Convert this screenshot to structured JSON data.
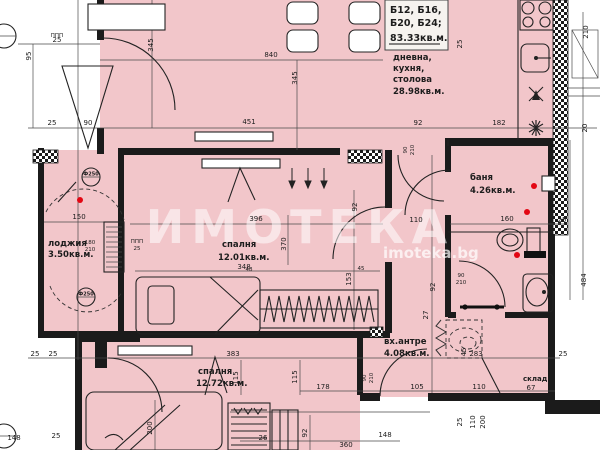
{
  "colors": {
    "room_fill": "#f2c6ca",
    "wall": "#1b1b1b",
    "red_dot": "#e30613",
    "hatch": "#1b1b1b"
  },
  "title_block": {
    "line1": "Б12, Б16,",
    "line2": "Б20, Б24;",
    "area": "83.33кв.м."
  },
  "watermark": {
    "brand": "ИМОТЕКА",
    "site": "imoteka.bg"
  },
  "rooms": {
    "living": {
      "l1": "дневна,",
      "l2": "кухня,",
      "l3": "столова",
      "area": "28.98кв.м."
    },
    "bedroom1": {
      "name": "спалня",
      "area": "12.01кв.м."
    },
    "bedroom2": {
      "name": "спалня",
      "area": "12.72кв.м."
    },
    "loggia": {
      "name": "лоджия",
      "area": "3.50кв.м."
    },
    "bath": {
      "name": "баня",
      "area": "4.26кв.м."
    },
    "entry": {
      "name": "вх.антре",
      "area": "4.08кв.м."
    },
    "storage": {
      "name": "склад"
    }
  },
  "markers": {
    "column1": "Ф250",
    "column2": "Ф250",
    "ppp1": "ППП",
    "ppp2": "ППП"
  },
  "dims": [
    "25",
    "345",
    "840",
    "345",
    "95",
    "210",
    "20",
    "25",
    "90",
    "451",
    "92",
    "182",
    "25",
    "150",
    "180",
    "210",
    "25",
    "396",
    "370",
    "348",
    "92",
    "153",
    "48",
    "45",
    "90",
    "210",
    "110",
    "160",
    "25",
    "90",
    "210",
    "27",
    "45",
    "92",
    "283",
    "25",
    "67",
    "105",
    "110",
    "25",
    "110",
    "200",
    "484",
    "25",
    "25",
    "90",
    "383",
    "115",
    "115",
    "200",
    "178",
    "92",
    "90",
    "210",
    "148",
    "26",
    "360",
    "148",
    "25"
  ]
}
